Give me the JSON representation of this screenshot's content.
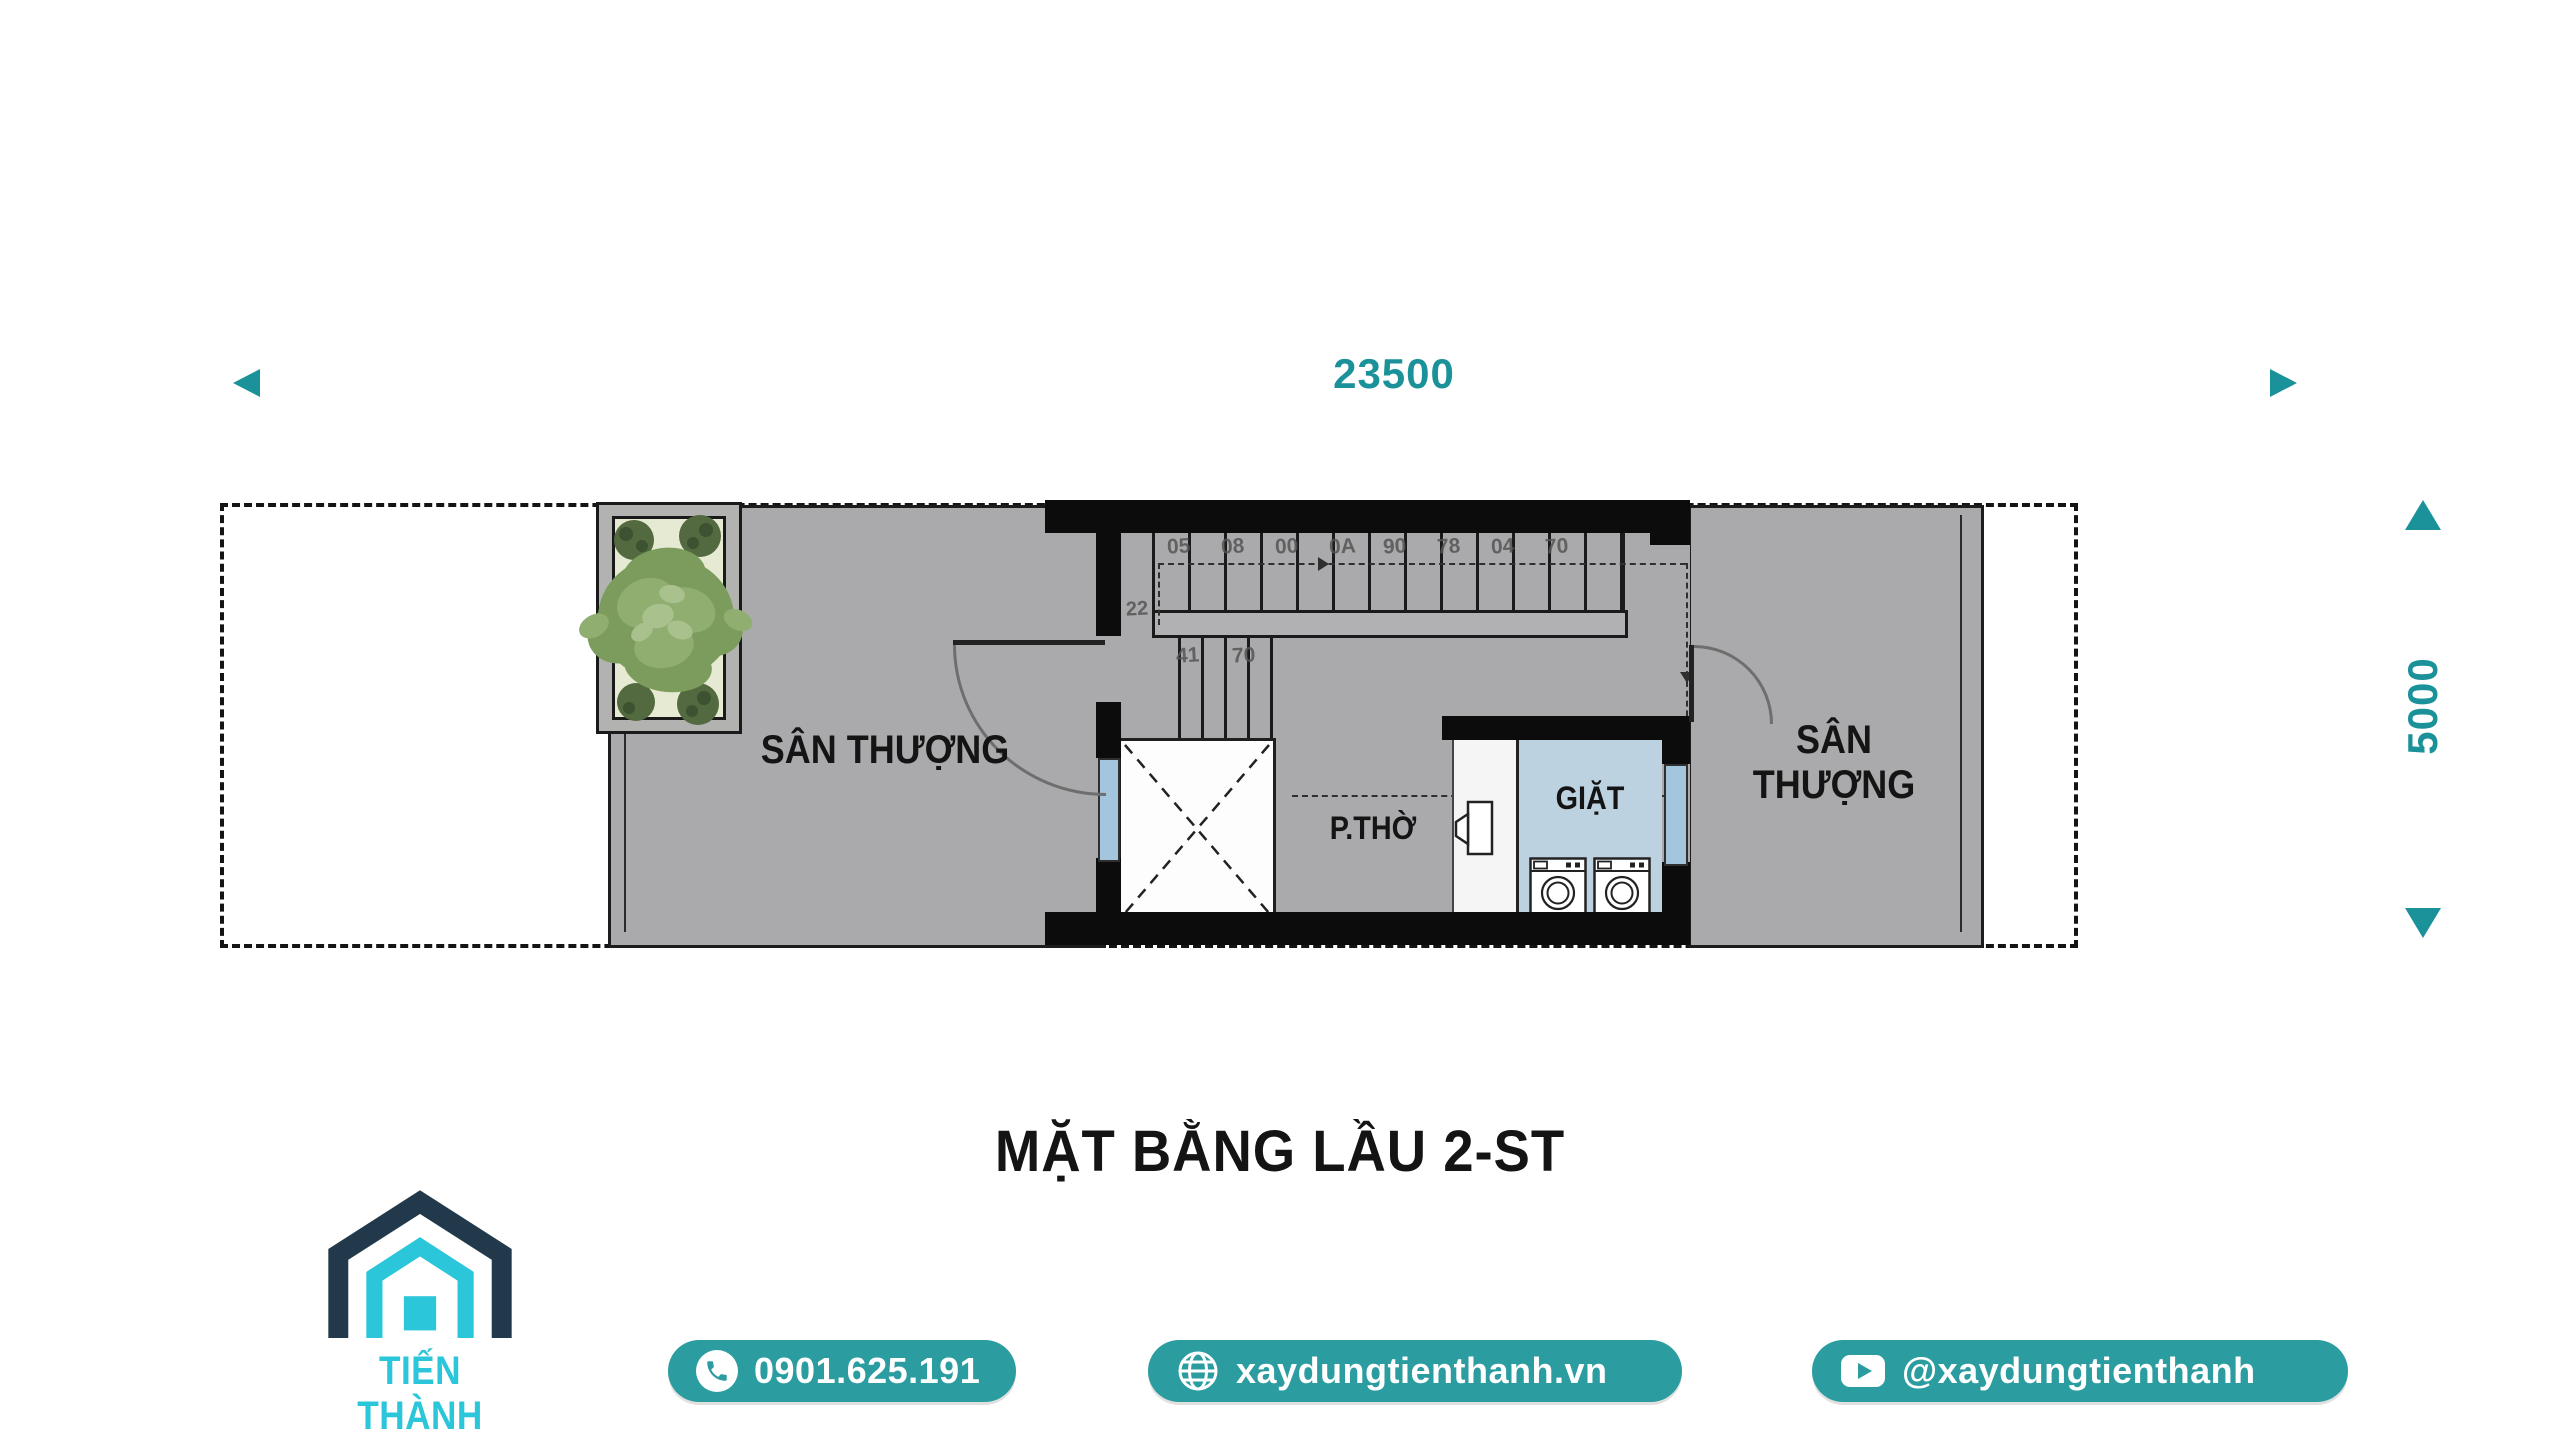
{
  "title": "MẶT BẰNG LẦU 2-ST",
  "dimensions": {
    "width": "23500",
    "height": "5000"
  },
  "rooms": {
    "terrace_left": "SÂN THƯỢNG",
    "terrace_right": "SÂN THƯỢNG",
    "worship": "P.THỜ",
    "laundry": "GIẶT"
  },
  "stairs": {
    "tread_numbers": [
      "05",
      "08",
      "00",
      "0A",
      "90",
      "78",
      "04",
      "70"
    ],
    "landing_number": "22",
    "lower_numbers": [
      "41",
      "70"
    ]
  },
  "footer": {
    "brand": "TIẾN THÀNH",
    "phone": "0901.625.191",
    "website": "xaydungtienthanh.vn",
    "youtube": "@xaydungtienthanh"
  },
  "colors": {
    "accent_teal": "#1b9199",
    "pill_teal": "#2b9da0",
    "logo_cyan": "#2bc6d9",
    "logo_navy": "#21394a",
    "floor_gray": "#aaaaac",
    "laundry_blue": "#bcd2e0",
    "window_blue": "#a3c6de",
    "wall_black": "#0c0c0c"
  },
  "icons": {
    "phone": "phone-handset",
    "website": "globe",
    "youtube": "play-button",
    "brand": "house-outline",
    "plant": "foliage",
    "dimension_arrows": "solid-triangles"
  }
}
